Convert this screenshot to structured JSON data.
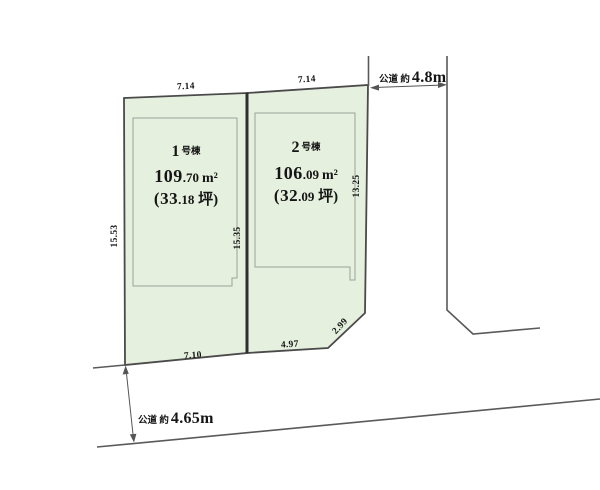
{
  "diagram": {
    "type": "land-plot-layout",
    "colors": {
      "plot_fill": "#e6f0df",
      "plot_outline": "#4a4a4a",
      "divider_line": "#2f2f2f",
      "footprint_line": "#9aa598",
      "road_line": "#5a5a5a",
      "arrow": "#555555",
      "text": "#151515",
      "background": "#ffffff"
    },
    "plots": [
      {
        "label_num": "1",
        "label_suffix": "号棟",
        "area_int": "109",
        "area_frac": ".70",
        "area_unit": "m²",
        "tsubo_int": "(33",
        "tsubo_frac": ".18",
        "tsubo_rest": " 坪)",
        "dim_top": "7.14",
        "dim_left": "15.53",
        "dim_bottom": "7.10"
      },
      {
        "label_num": "2",
        "label_suffix": "号棟",
        "area_int": "106",
        "area_frac": ".09",
        "area_unit": "m²",
        "tsubo_int": "(32",
        "tsubo_frac": ".09",
        "tsubo_rest": " 坪)",
        "dim_top": "7.14",
        "dim_left": "15.35",
        "dim_right": "13.25",
        "dim_bottom": "4.97",
        "dim_diagonal": "2.99"
      }
    ],
    "roads": {
      "right": {
        "prefix": "公道 約",
        "value": "4.8m"
      },
      "bottom": {
        "prefix": "公道 約",
        "value": "4.65m"
      }
    }
  }
}
